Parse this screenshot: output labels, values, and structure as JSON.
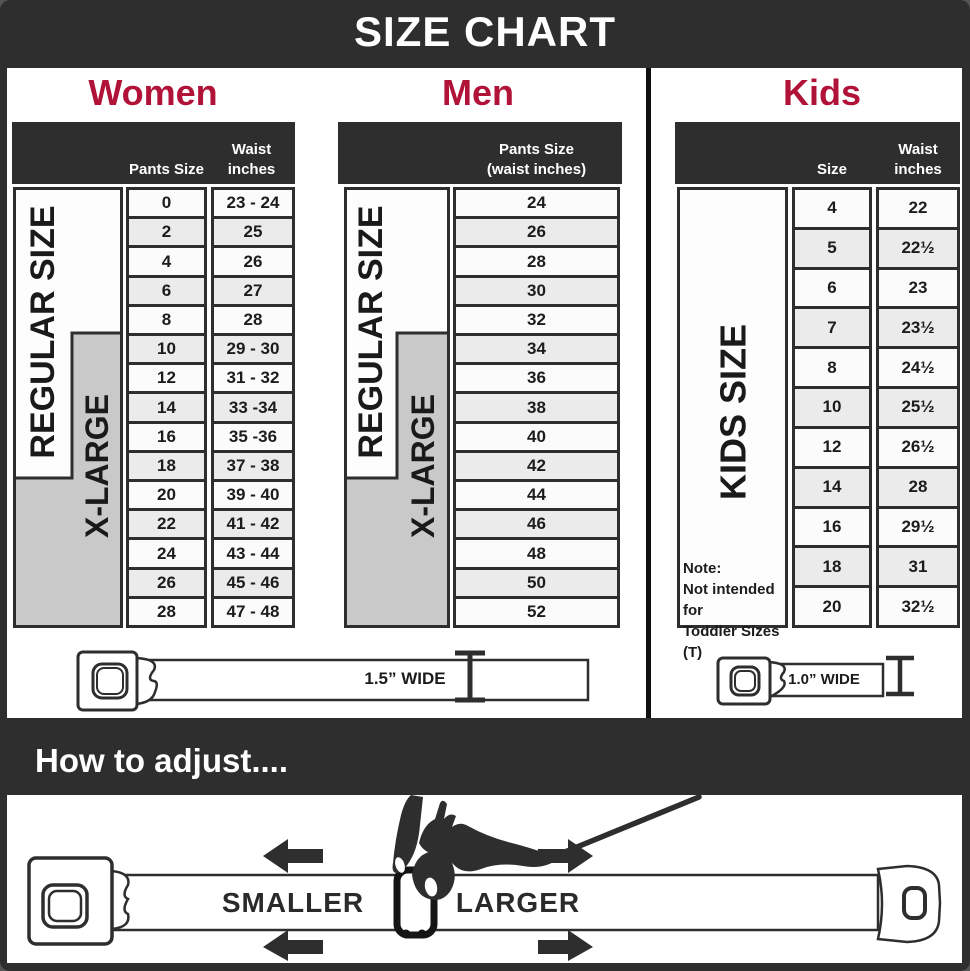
{
  "title": "SIZE CHART",
  "colors": {
    "band": "#2e2e2e",
    "accent": "#b01238",
    "xlarge_box": "#c9c9c9"
  },
  "women": {
    "heading": "Women",
    "header": {
      "pants": "Pants Size",
      "waist_line1": "Waist",
      "waist_line2": "inches"
    },
    "regular_label": "REGULAR SIZE",
    "xlarge_label": "X-LARGE",
    "rows": [
      {
        "size": "0",
        "waist": "23 - 24"
      },
      {
        "size": "2",
        "waist": "25"
      },
      {
        "size": "4",
        "waist": "26"
      },
      {
        "size": "6",
        "waist": "27"
      },
      {
        "size": "8",
        "waist": "28"
      },
      {
        "size": "10",
        "waist": "29 - 30"
      },
      {
        "size": "12",
        "waist": "31 - 32"
      },
      {
        "size": "14",
        "waist": "33 -34"
      },
      {
        "size": "16",
        "waist": "35 -36"
      },
      {
        "size": "18",
        "waist": "37 - 38"
      },
      {
        "size": "20",
        "waist": "39 - 40"
      },
      {
        "size": "22",
        "waist": "41 - 42"
      },
      {
        "size": "24",
        "waist": "43 - 44"
      },
      {
        "size": "26",
        "waist": "45 - 46"
      },
      {
        "size": "28",
        "waist": "47 - 48"
      }
    ],
    "belt_width_label": "1.5” WIDE"
  },
  "men": {
    "heading": "Men",
    "header": {
      "line1": "Pants Size",
      "line2": "(waist inches)"
    },
    "regular_label": "REGULAR SIZE",
    "xlarge_label": "X-LARGE",
    "rows": [
      "24",
      "26",
      "28",
      "30",
      "32",
      "34",
      "36",
      "38",
      "40",
      "42",
      "44",
      "46",
      "48",
      "50",
      "52"
    ]
  },
  "kids": {
    "heading": "Kids",
    "header": {
      "size": "Size",
      "waist_line1": "Waist",
      "waist_line2": "inches"
    },
    "label": "KIDS SIZE",
    "note_line1": "Note:",
    "note_line2": "Not intended for",
    "note_line3": "Toddler Sizes (T)",
    "rows": [
      {
        "size": "4",
        "waist": "22"
      },
      {
        "size": "5",
        "waist": "22½"
      },
      {
        "size": "6",
        "waist": "23"
      },
      {
        "size": "7",
        "waist": "23½"
      },
      {
        "size": "8",
        "waist": "24½"
      },
      {
        "size": "10",
        "waist": "25½"
      },
      {
        "size": "12",
        "waist": "26½"
      },
      {
        "size": "14",
        "waist": "28"
      },
      {
        "size": "16",
        "waist": "29½"
      },
      {
        "size": "18",
        "waist": "31"
      },
      {
        "size": "20",
        "waist": "32½"
      }
    ],
    "belt_width_label": "1.0” WIDE"
  },
  "adjust": {
    "heading": "How to adjust....",
    "smaller_label": "SMALLER",
    "larger_label": "LARGER"
  }
}
